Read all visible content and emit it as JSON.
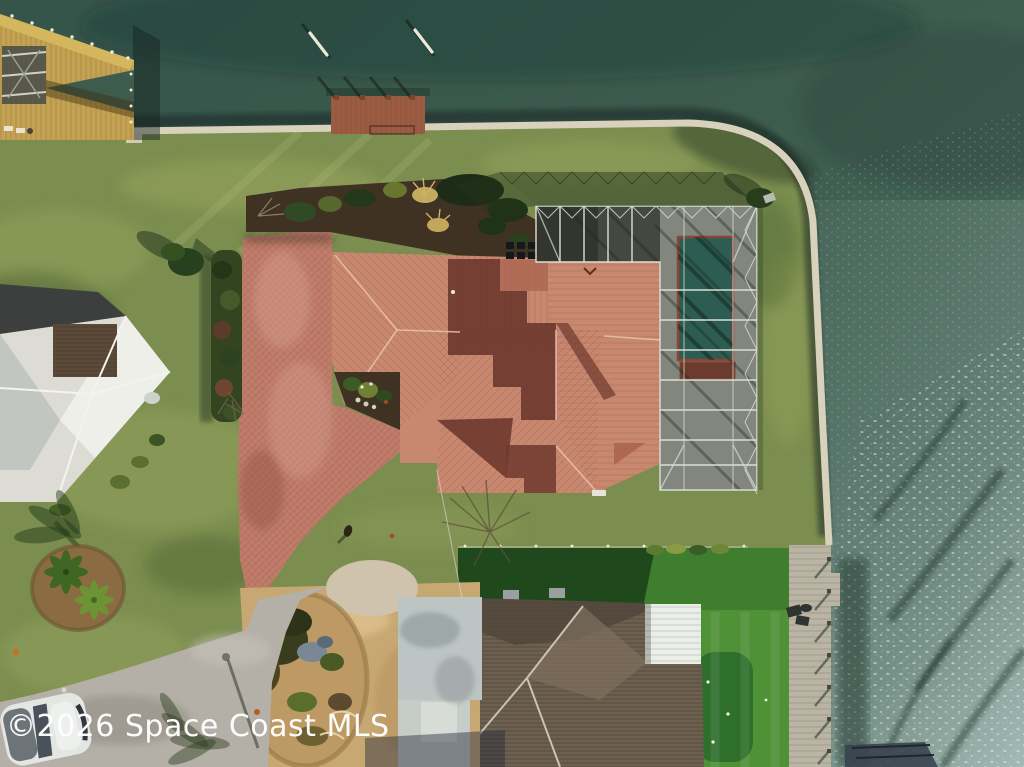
{
  "watermark": {
    "text": "©2026 Space Coast MLS"
  },
  "scene": {
    "view": "aerial-drone-photo",
    "subject": "waterfront-home-with-pool-enclosure-and-docks"
  },
  "colors": {
    "water": "#3d5c4e",
    "water_glint": "#7d948a",
    "grass": "#7b8d4f",
    "turf": "#3f7e2e",
    "putting_green": "#2e6f2b",
    "roof": "#c8876f",
    "roof_mid": "#ad6753",
    "roof_shadow": "#6e392e",
    "ridge": "#e9c4ae",
    "pavers": "#c07d6c",
    "seawall": "#d8d1bc",
    "pool": "#2d5c52",
    "pool_coping": "#8a4536",
    "lanai": "#44483f",
    "cage": "#dadfd6",
    "mulch": "#3f3222",
    "hedge": "#324420",
    "neighbor_roof": "#dcdcd4",
    "neighbor_dark": "#3c3f3e",
    "neighbor_brown": "#5c4a38",
    "shingle": "#6e6050",
    "shingle_dark": "#51463b",
    "white_panel": "#eceeea",
    "pad": "#bdc5c4",
    "road": "#b5b0a7",
    "sand": "#c7a772",
    "dock_wood": "#c3a253",
    "dock_brown": "#9c5c44",
    "boardwalk": "#bab4a4",
    "watermark": "#ffffff"
  }
}
